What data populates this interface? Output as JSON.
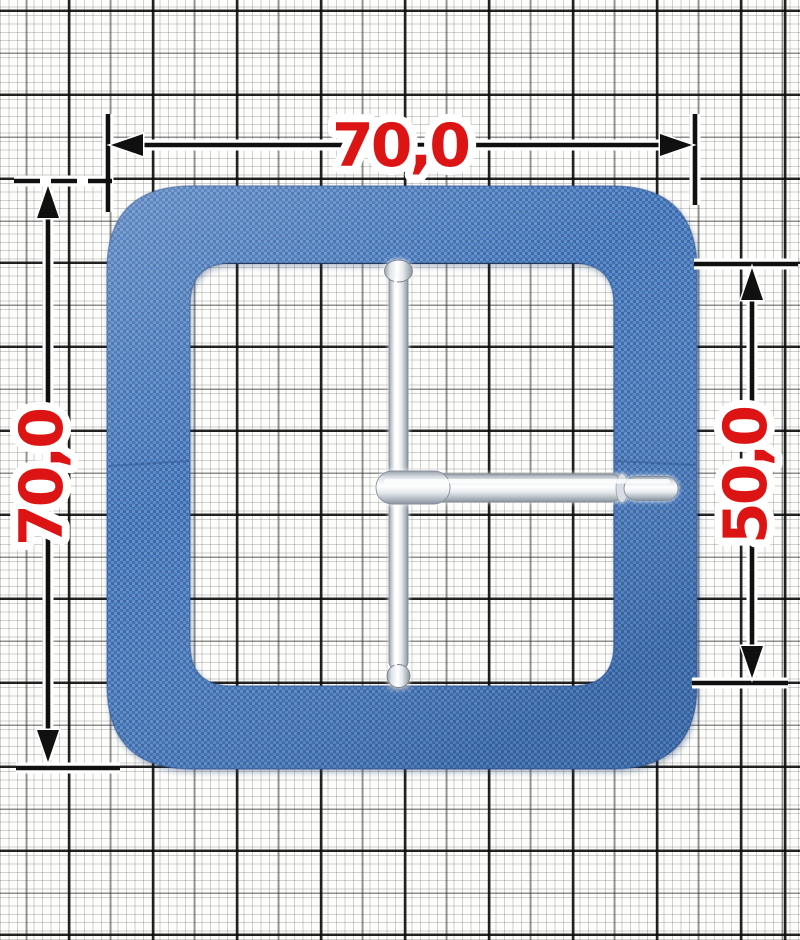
{
  "scene": {
    "description": "Square belt buckle covered in blue fabric with metal prong and center bar, photographed on millimeter graph paper with dimension annotations",
    "background": "millimeter graph paper",
    "colors": {
      "dimension_text": "#dd1414",
      "dimension_lines": "#101010",
      "dimension_halo": "#ffffff",
      "buckle_fabric": "#4a7cbe",
      "buckle_fabric_dark": "#3c68a6",
      "buckle_fabric_light": "#6b97d2",
      "metal_highlight": "#ffffff",
      "metal_mid": "#dfe4e9",
      "metal_shadow": "#8b939d",
      "paper": "#fdfdfb"
    }
  },
  "annotations": {
    "top_width_label": "70,0",
    "left_height_label": "70,0",
    "right_inner_height_label": "50,0"
  }
}
